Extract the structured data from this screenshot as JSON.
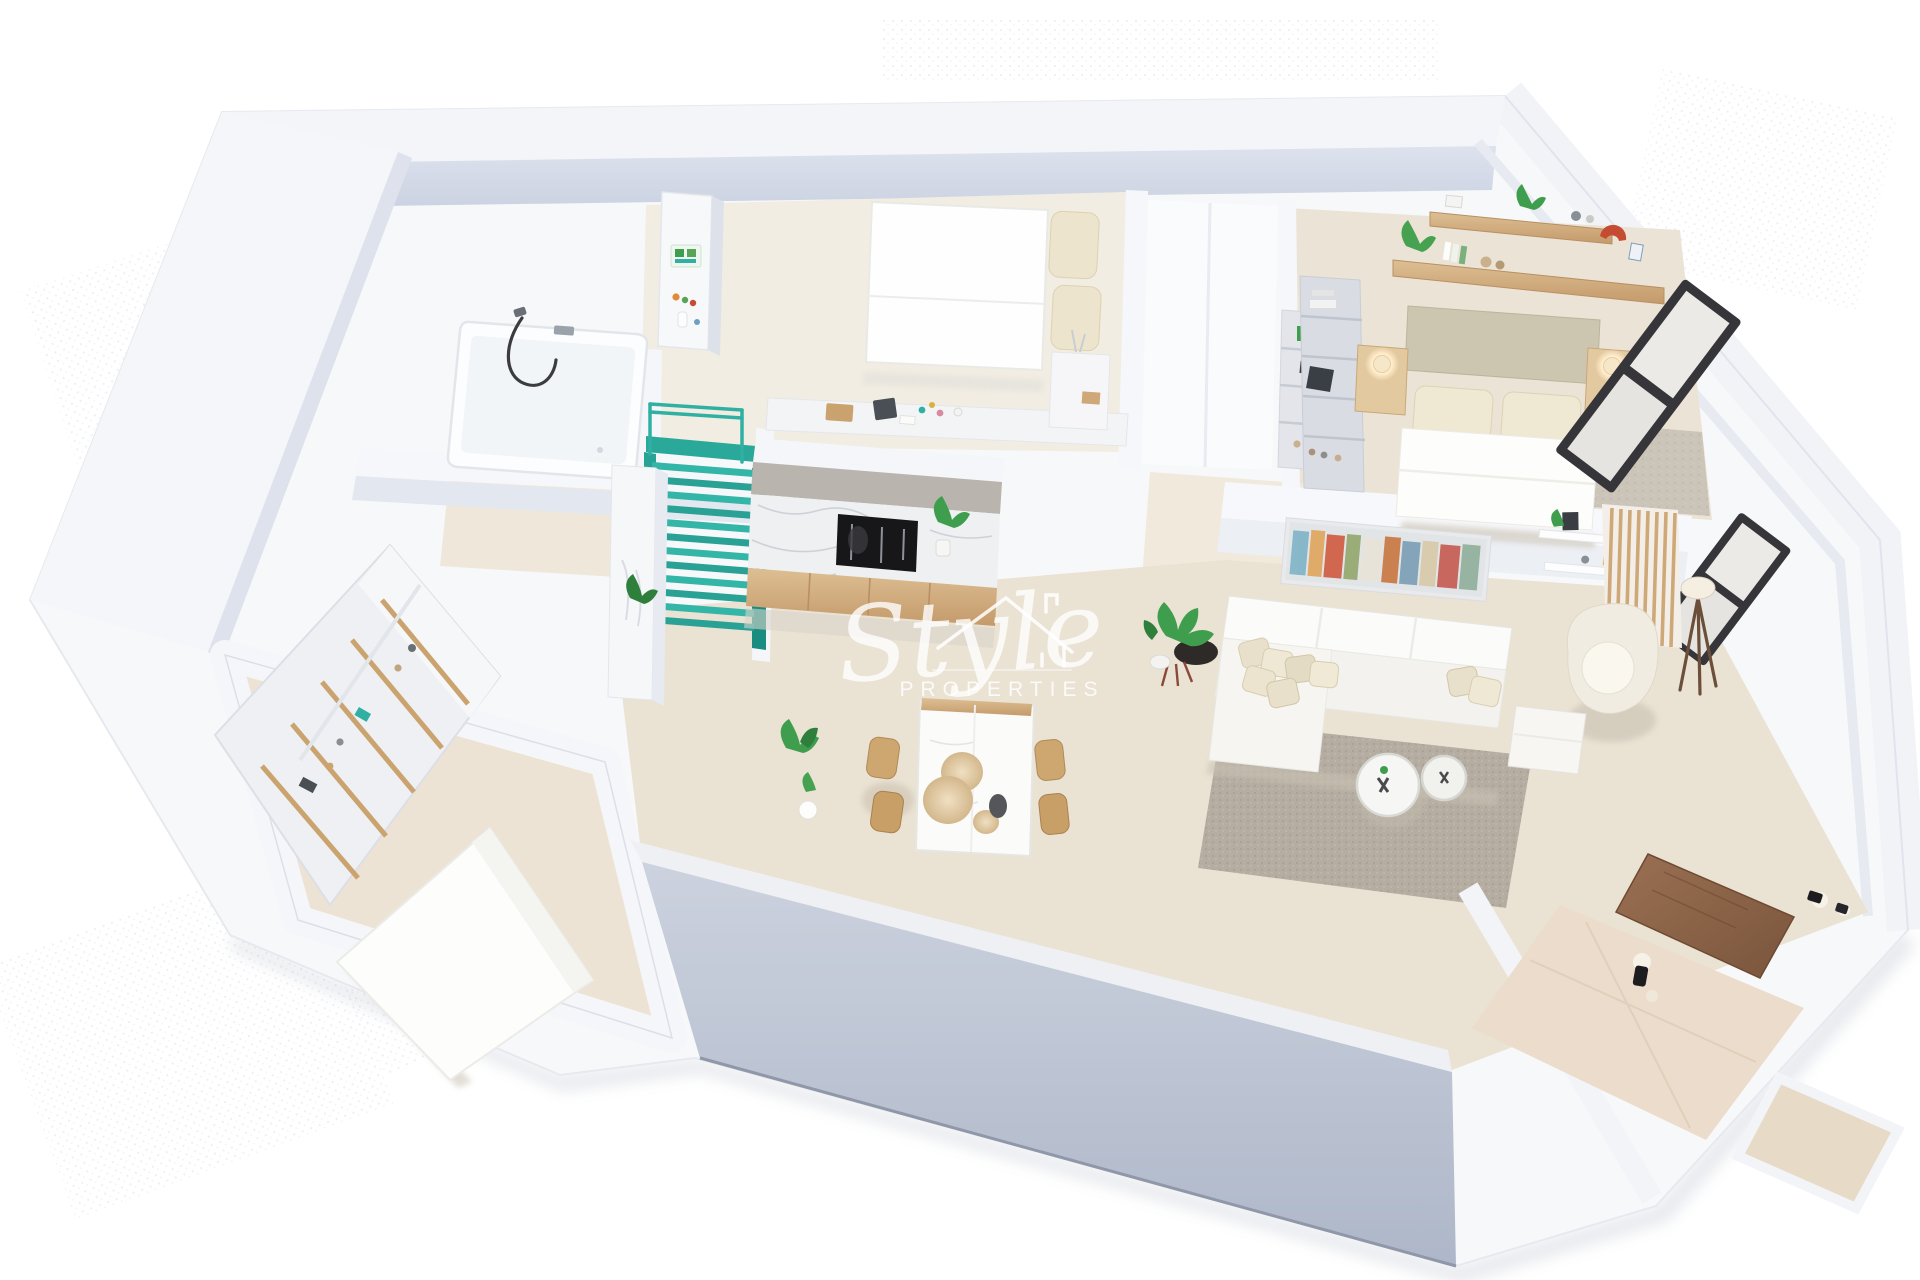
{
  "canvas": {
    "width": 1920,
    "height": 1280,
    "background": "#ffffff"
  },
  "scene": {
    "type": "3d-floorplan-isometric-render",
    "description": "Isometric 3D architectural render of an apartment floor plan viewed from above on a white background"
  },
  "watermark": {
    "brand_script": "Style",
    "brand_sub": "PROPERTIES",
    "icon": "house-roof-icon",
    "color": "#ffffff",
    "opacity": 0.8
  },
  "palette": {
    "wall_top": "#f6f7fa",
    "wall_face": "#d6dbe8",
    "front_wall": "#bfc6d6",
    "floor_cream": "#f2ede2",
    "floor_beige": "#eae2d3",
    "carpet": "#c9c2b7",
    "rug": "#b7afa3",
    "stairs_teal": "#2fb0a3",
    "stairs_teal_dark": "#1a8c80",
    "wood": "#d5b284",
    "wood_dark": "#a97c52",
    "door_wood": "#8d6448",
    "marble": "#eff0f2",
    "appliance_black": "#17171a",
    "lamp_glow": "#ffe9c2",
    "plant_green": "#3f9e4d",
    "accent_red": "#c64b33",
    "cushion": "#e8e0cb"
  },
  "rooms": [
    {
      "id": "bathroom",
      "name": "Bathroom",
      "furniture": [
        "bathtub",
        "shower-hose",
        "faucet",
        "shelf-column"
      ]
    },
    {
      "id": "bedroom-1",
      "name": "Bedroom 1",
      "furniture": [
        "double-bed",
        "pillows",
        "desk-ledge",
        "nightstand"
      ]
    },
    {
      "id": "closet",
      "name": "Built-in wardrobe",
      "furniture": [
        "open-closet",
        "display-shelf"
      ]
    },
    {
      "id": "bedroom-2",
      "name": "Master bedroom",
      "furniture": [
        "double-bed",
        "headboard",
        "nightstand-left",
        "nightstand-right",
        "bedside-lamps",
        "wall-shelves",
        "plants",
        "wardrobe-shelves",
        "windows"
      ]
    },
    {
      "id": "staircase",
      "name": "Staircase",
      "furniture": [
        "teal-stairs",
        "railing",
        "landing"
      ]
    },
    {
      "id": "kitchen",
      "name": "Kitchen",
      "furniture": [
        "marble-backsplash",
        "built-in-oven-niche",
        "wood-cabinets",
        "tall-cabinet",
        "plant"
      ]
    },
    {
      "id": "dining",
      "name": "Dining area",
      "furniture": [
        "marble-table",
        "wood-chairs",
        "pendant-sphere-lamps",
        "plant",
        "pedestal"
      ]
    },
    {
      "id": "living",
      "name": "Living room",
      "furniture": [
        "corner-sofa",
        "cushions",
        "round-coffee-tables",
        "area-rug",
        "armchair",
        "ottoman",
        "floor-lamp",
        "wall-art",
        "wall-shelves",
        "wood-slat-partition",
        "planter",
        "plant"
      ]
    },
    {
      "id": "dressing-bedroom",
      "name": "Bedroom 3 / dressing room",
      "furniture": [
        "shelving-unit",
        "double-bed"
      ]
    },
    {
      "id": "entry",
      "name": "Entrance hall",
      "furniture": [
        "wood-door",
        "wall-sconces",
        "tiled-floor",
        "terrace-step"
      ]
    }
  ]
}
